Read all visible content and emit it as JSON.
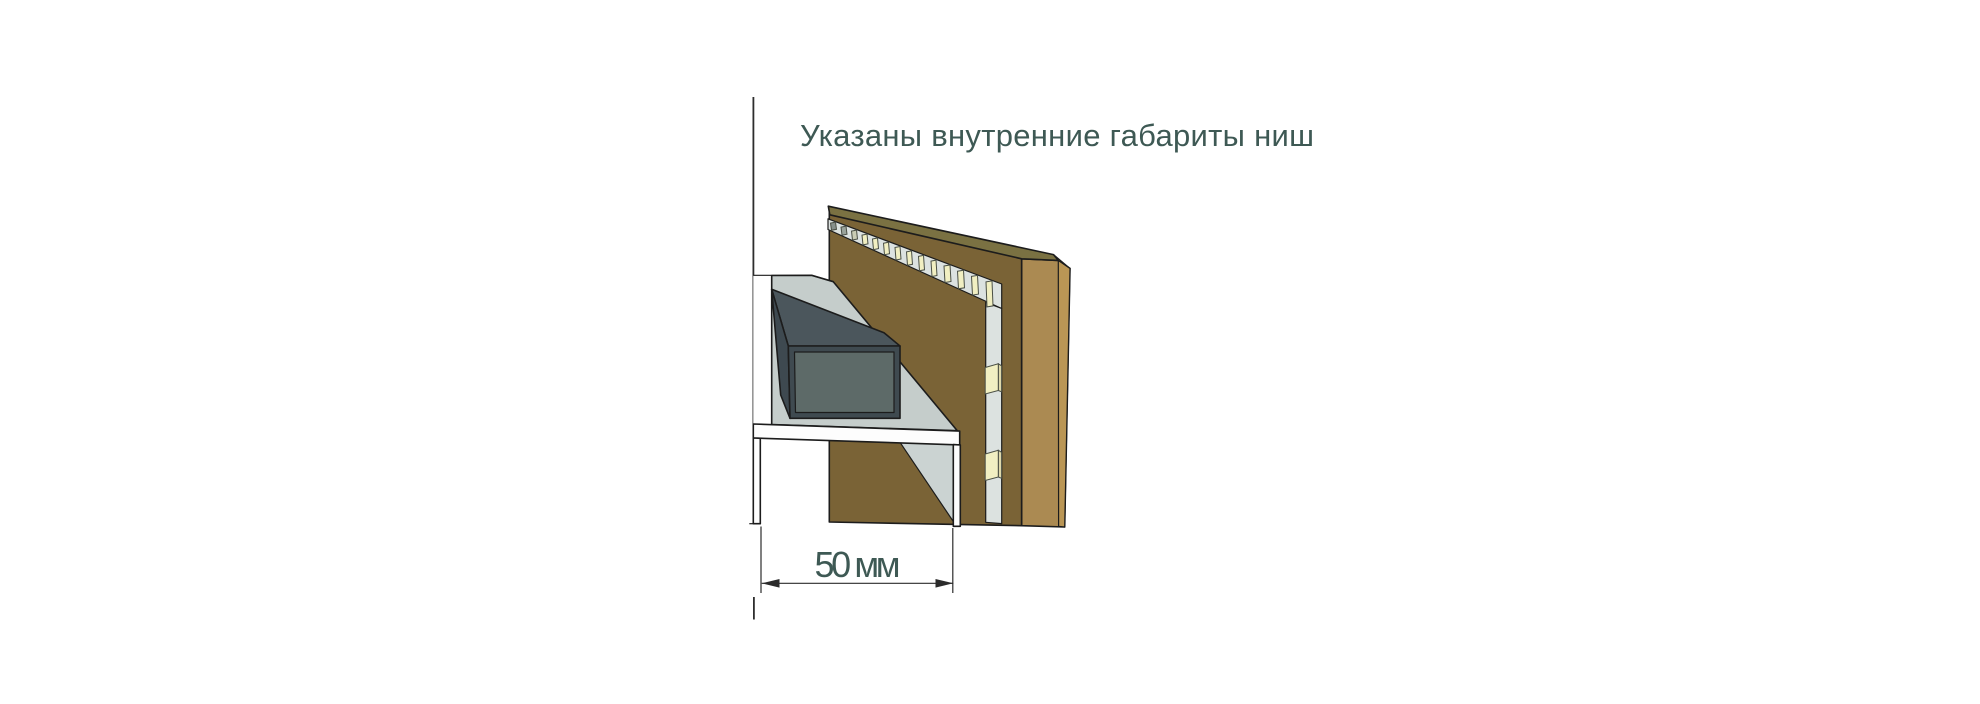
{
  "diagram": {
    "note": "Указаны внутренние габариты ниш",
    "dimension": {
      "value": "50 мм"
    },
    "colors": {
      "note_text": "#3e5954",
      "outline": "#1c1c1c",
      "wall_line": "#2e2e2e",
      "panel_front_brown": "#7a6336",
      "panel_side_tan": "#ab8a52",
      "panel_edge_tan_light": "#ba9655",
      "panel_top_olive": "#7a7142",
      "led_channel_gray": "#dce2e0",
      "led_cream": "#f1efc2",
      "wall_white": "#ffffff",
      "shelf_gray": "#c5cdcb",
      "shelf_inner_gray": "#cbd3d2",
      "channel_white": "#fdfdfd",
      "duct_top": "#4b565c",
      "duct_side": "#3e4950",
      "duct_frame": "#3f4a50",
      "duct_inner": "#5d6a68"
    }
  }
}
